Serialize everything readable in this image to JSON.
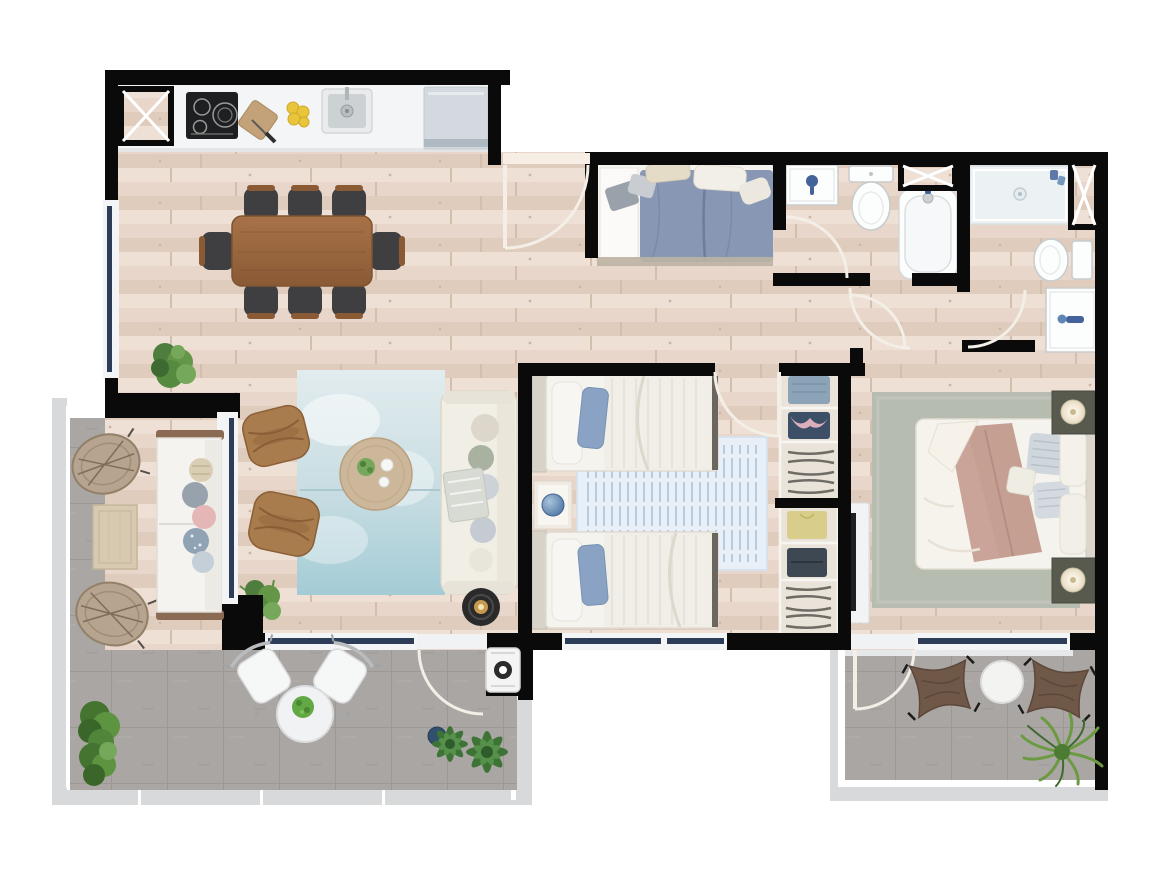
{
  "title": "apartment-floor-plan-top-view",
  "palette": {
    "exterior": "#ffffff",
    "wall": "#0a0a0a",
    "wood_floor": "#e7d6c9",
    "wood_floor_light": "#eee0d5",
    "wood_floor_dark": "#dfccbd",
    "wood_seam": "#d3bfae",
    "terrace_floor": "#a9a6a3",
    "terrace_line": "#9b9895",
    "railing_gray": "#d7d9db",
    "window_navy": "#2e3d57",
    "window_frame": "#f3f4f5",
    "counter_white": "#f4f5f6",
    "appliance_gray": "#d3d9de",
    "cooktop_black": "#1d1f20",
    "sink_gray": "#ccd1d4",
    "lemon_yellow": "#e8c53a",
    "table_wood": "#9c6b42",
    "chair_dark": "#3f3f41",
    "chair_wood": "#8a5a35",
    "rug_living_a": "#e2ecee",
    "rug_living_b": "#a4ccd6",
    "rug_twin": "#e8eff6",
    "rug_twin_stripe": "#a9c4dd",
    "rug_master": "#b7bcb1",
    "sofa_cream": "#f1eee6",
    "rattan_brown": "#a97c4e",
    "side_table_black": "#2a2a2a",
    "candle_gold": "#c59a4e",
    "duvet_blue": "#8898b4",
    "pillow_blue": "#8aa3c4",
    "duvet_mauve": "#c69f93",
    "bed_white": "#f5f3ee",
    "headboard_beige": "#dcd6ca",
    "nightstand_olive": "#585a4e",
    "fixture_white": "#fcfdfd",
    "fixture_stroke": "#c7cbcd",
    "shower_tray": "#ecf1f4",
    "accent_blue": "#44639b",
    "closet_bg": "#eae3da",
    "clothes_blue": "#8ca3b8",
    "clothes_pink": "#dbaebc",
    "clothes_yellow": "#d9cd8b",
    "clothes_dark": "#3e4852",
    "hanger_gray": "#6f6c66",
    "plant_green": "#4e7d3e",
    "plant_green_light": "#76a85c",
    "wicker_tan": "#b7a490",
    "outdoor_table_wood": "#d8c9b2",
    "butterfly_brown": "#6f5848",
    "tv_black": "#1f2022"
  },
  "rooms": [
    {
      "id": "kitchen",
      "floor": "wood"
    },
    {
      "id": "dining-area",
      "floor": "wood"
    },
    {
      "id": "living-room",
      "floor": "wood"
    },
    {
      "id": "entry-hall",
      "floor": "wood"
    },
    {
      "id": "bedroom-top",
      "floor": "wood"
    },
    {
      "id": "twin-bedroom",
      "floor": "wood"
    },
    {
      "id": "master-bedroom",
      "floor": "wood"
    },
    {
      "id": "bathroom",
      "floor": "wood"
    },
    {
      "id": "ensuite-bathroom",
      "floor": "wood"
    },
    {
      "id": "hallway",
      "floor": "wood"
    },
    {
      "id": "wardrobe-closets",
      "floor": "wood"
    },
    {
      "id": "terrace-left",
      "floor": "concrete-tile"
    },
    {
      "id": "terrace-right",
      "floor": "concrete-tile"
    }
  ],
  "furniture": [
    "kitchen-counter",
    "induction-cooktop",
    "kitchen-sink",
    "refrigerator",
    "cutting-board-knife",
    "lemons",
    "dining-table",
    "dining-chairs-x8",
    "blue-area-rug",
    "rattan-armchairs-x2",
    "round-coffee-table",
    "cream-sofa",
    "black-side-table-candle",
    "double-bed-blue-duvet",
    "twin-beds-x2",
    "twin-nightstand-sphere-lamp",
    "wardrobe-shelves-x2",
    "master-bed-mauve-duvet",
    "master-nightstands-lamps-x2",
    "tv-sideboard",
    "vanity-sink-x2",
    "toilet-x2",
    "bathtub",
    "shower-tray",
    "outdoor-sofa",
    "wicker-lounge-chairs-x2",
    "outdoor-coffee-table",
    "bistro-table-chairs-x2",
    "butterfly-chairs-x2",
    "outdoor-side-table",
    "ac-unit",
    "potted-plants",
    "service-shafts-x3"
  ]
}
